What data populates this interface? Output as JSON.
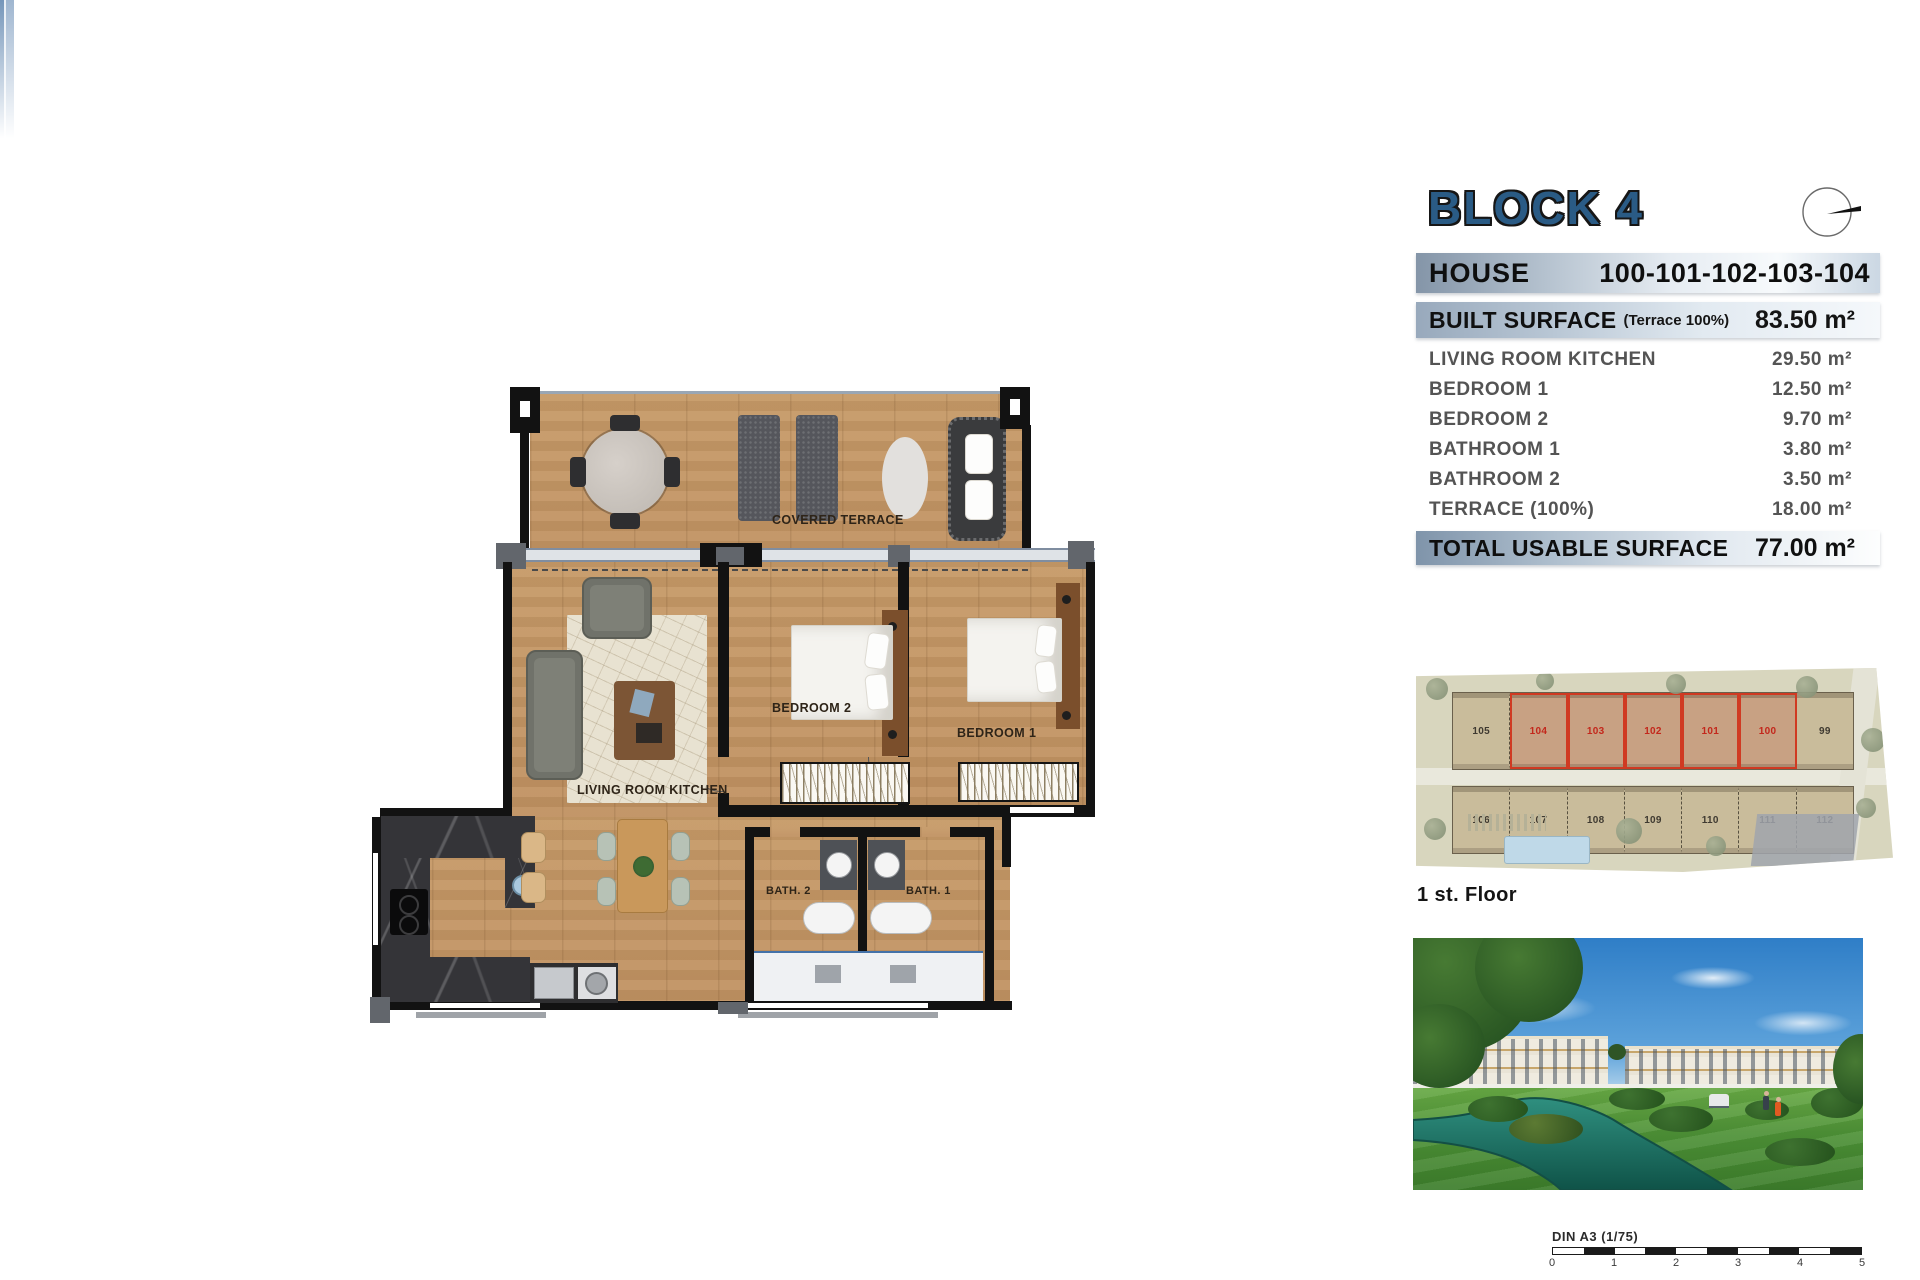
{
  "colors": {
    "title_blue": "#2A5B85",
    "bar_gradient_left": "#8495A8",
    "bar_gradient_right": "#CBD7E3",
    "highlight_red": "#D03A22",
    "plan_wood": "#C69A67",
    "plan_wall": "#121212",
    "water": "#1C6E63",
    "grass": "#4D9136",
    "sky": "#2F7EC7"
  },
  "panel": {
    "title": "BLOCK 4",
    "house": {
      "label": "HOUSE",
      "numbers": "100-101-102-103-104"
    },
    "built_surface": {
      "label": "BUILT SURFACE",
      "note": "(Terrace 100%)",
      "value": "83.50 m²"
    },
    "rooms": [
      {
        "label": "LIVING ROOM KITCHEN",
        "value": "29.50 m²"
      },
      {
        "label": "BEDROOM 1",
        "value": "12.50 m²"
      },
      {
        "label": "BEDROOM 2",
        "value": "9.70 m²"
      },
      {
        "label": "BATHROOM 1",
        "value": "3.80 m²"
      },
      {
        "label": "BATHROOM 2",
        "value": "3.50 m²"
      },
      {
        "label": "TERRACE (100%)",
        "value": "18.00 m²"
      }
    ],
    "total": {
      "label": "TOTAL USABLE SURFACE",
      "value": "77.00 m²"
    }
  },
  "floor_plan": {
    "labels": {
      "terrace": "COVERED TERRACE",
      "living": "LIVING ROOM KITCHEN",
      "bedroom2": "BEDROOM 2",
      "bedroom1": "BEDROOM 1",
      "bath2": "BATH. 2",
      "bath1": "BATH. 1"
    }
  },
  "site_plan": {
    "caption": "1 st. Floor",
    "units_top": [
      "105",
      "104",
      "103",
      "102",
      "101",
      "100",
      "99"
    ],
    "highlighted_units": [
      "104",
      "103",
      "102",
      "101",
      "100"
    ],
    "units_bottom": [
      "106",
      "107",
      "108",
      "109",
      "110",
      "111",
      "112"
    ]
  },
  "scale_bar": {
    "label": "DIN A3 (1/75)",
    "ticks": [
      "0",
      "1",
      "2",
      "3",
      "4",
      "5"
    ]
  }
}
